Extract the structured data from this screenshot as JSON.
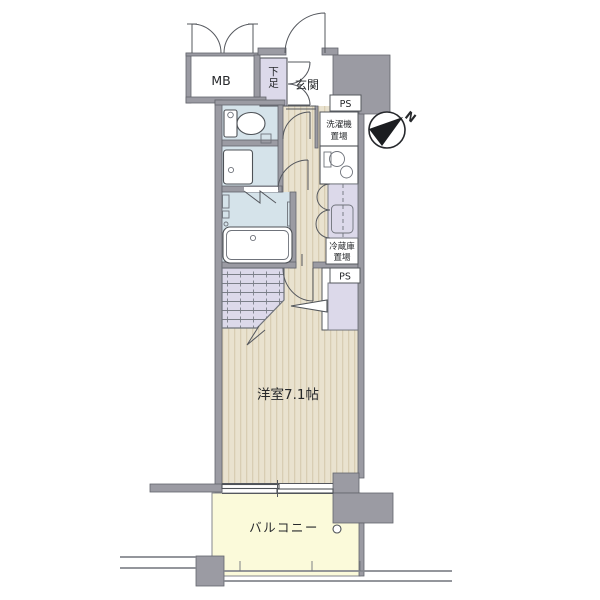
{
  "plan": {
    "labels": {
      "mb": "MB",
      "shoe": "下足",
      "genkan": "玄関",
      "ps_top": "PS",
      "washer_line1": "洗濯機",
      "washer_line2": "置場",
      "fridge_line1": "冷蔵庫",
      "fridge_line2": "置場",
      "ps_mid": "PS",
      "main_room": "洋室7.1帖",
      "balcony": "バルコニー",
      "north": "N"
    },
    "colors": {
      "wall": "#9b9ba3",
      "water": "#d5e3ea",
      "closet": "#dcd9ea",
      "balcony": "#fbfada",
      "wood": "#e9e2cf",
      "wood_stripe": "#d8cdb3",
      "line": "#55585e"
    }
  }
}
